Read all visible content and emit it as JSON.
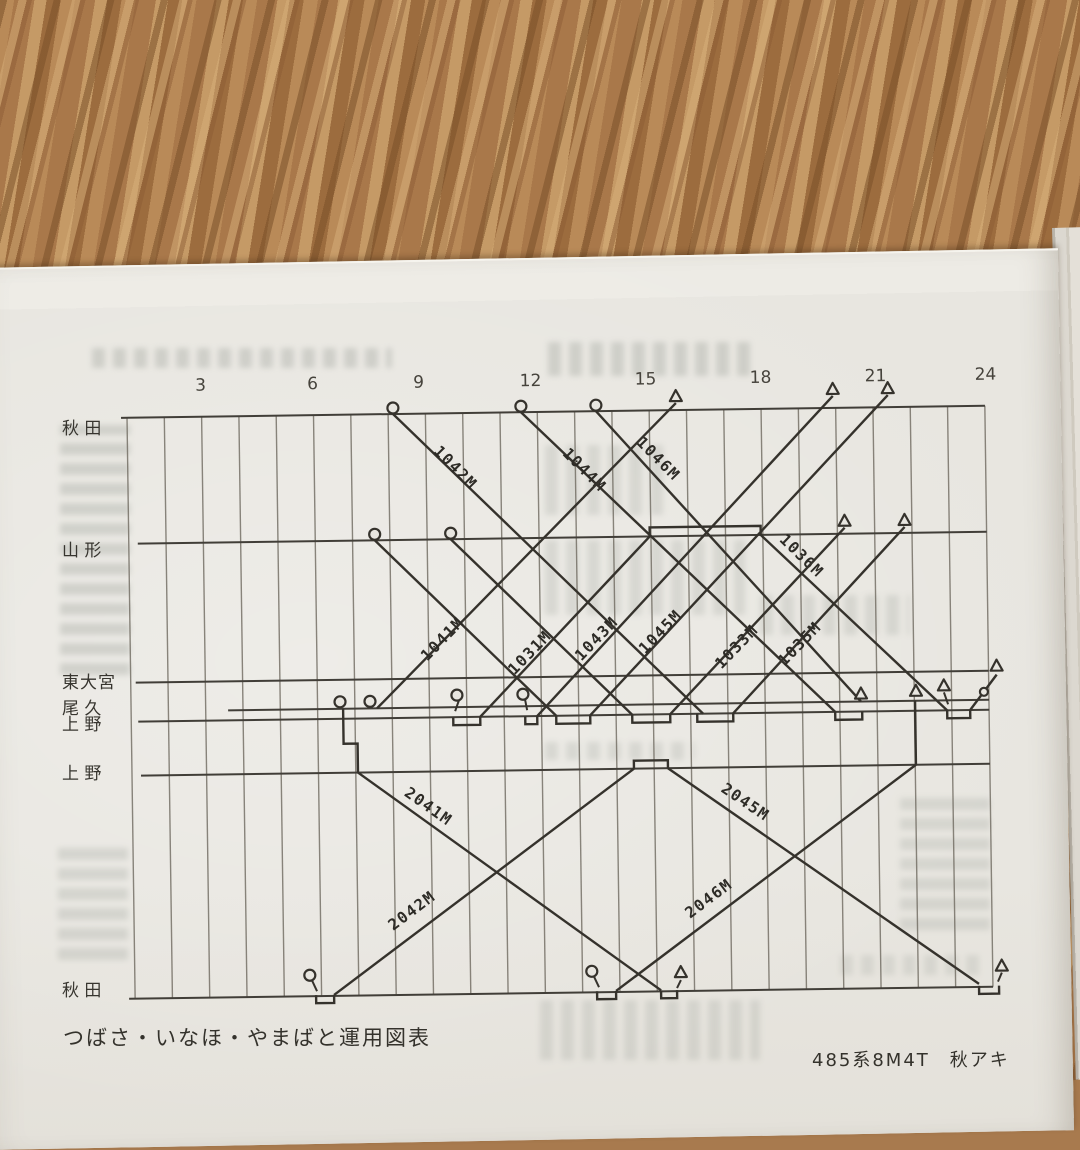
{
  "page": {
    "caption_left": "つばさ・いなほ・やまばと運用図表",
    "caption_right": "485系8M4T　秋アキ"
  },
  "diagram": {
    "title": "train operation diagram (運用図表)",
    "ink": "#35322c",
    "grid_ink": "#6f6a60",
    "paper": "#e8e6e0",
    "hours": {
      "labels": [
        "3",
        "6",
        "9",
        "12",
        "15",
        "18",
        "21",
        "24"
      ],
      "x": [
        205,
        317,
        423,
        535,
        650,
        765,
        880,
        990
      ],
      "y": 386
    },
    "grid": {
      "x0": 131,
      "dx": 37.3,
      "count": 24,
      "top": 412,
      "bottom": 993
    },
    "stations": [
      {
        "label": "秋 田",
        "y": 412,
        "x1": 125,
        "x2": 989,
        "label_top": 414
      },
      {
        "label": "山 形",
        "y": 538,
        "x1": 140,
        "x2": 989,
        "label_top": 536
      },
      {
        "label": "東大宮",
        "y": 677,
        "x1": 136,
        "x2": 989,
        "label_top": 668
      },
      {
        "label": "尾 久",
        "y": 706,
        "x1": 228,
        "x2": 989,
        "label_top": 694
      },
      {
        "label": "上 野",
        "y": 716,
        "x1": 138,
        "x2": 989,
        "label_top": 710
      },
      {
        "label": "上 野",
        "y": 770,
        "x1": 140,
        "x2": 989,
        "label_top": 759
      },
      {
        "label": "秋 田",
        "y": 993,
        "x1": 125,
        "x2": 989,
        "label_top": 976
      }
    ],
    "trains": [
      {
        "label": "1042M",
        "path": [
          [
            397,
            412
          ],
          [
            703,
            716
          ]
        ],
        "lx": 455,
        "ly": 470,
        "rot": 46
      },
      {
        "label": "1044M",
        "path": [
          [
            525,
            412
          ],
          [
            835,
            716
          ]
        ],
        "lx": 584,
        "ly": 474,
        "rot": 46
      },
      {
        "label": "1046M",
        "path": [
          [
            600,
            412
          ],
          [
            861,
            706
          ]
        ],
        "lx": 658,
        "ly": 464,
        "rot": 46
      },
      {
        "label": "",
        "path": [
          [
            377,
            538
          ],
          [
            556,
            716
          ]
        ]
      },
      {
        "label": "",
        "path": [
          [
            453,
            538
          ],
          [
            632,
            716
          ]
        ]
      },
      {
        "label": "1036M",
        "path": [
          [
            652,
            538
          ],
          [
            652,
            529
          ],
          [
            763,
            529
          ],
          [
            763,
            538
          ],
          [
            947,
            716
          ]
        ],
        "lx": 800,
        "ly": 563,
        "rot": 45
      },
      {
        "label": "1041M",
        "path": [
          [
            377,
            706
          ],
          [
            680,
            405
          ]
        ],
        "lx": 447,
        "ly": 641,
        "rot": -45
      },
      {
        "label": "1031M",
        "path": [
          [
            480,
            716
          ],
          [
            652,
            538
          ]
        ],
        "lx": 534,
        "ly": 656,
        "rot": -45
      },
      {
        "label": "1043M",
        "path": [
          [
            537,
            716
          ],
          [
            837,
            400
          ]
        ],
        "lx": 601,
        "ly": 643,
        "rot": -45
      },
      {
        "label": "1045M",
        "path": [
          [
            590,
            716
          ],
          [
            892,
            400
          ]
        ],
        "lx": 665,
        "ly": 637,
        "rot": -45
      },
      {
        "label": "1033M",
        "path": [
          [
            670,
            716
          ],
          [
            847,
            532
          ]
        ],
        "lx": 741,
        "ly": 653,
        "rot": -45
      },
      {
        "label": "1035M",
        "path": [
          [
            733,
            716
          ],
          [
            907,
            532
          ]
        ],
        "lx": 804,
        "ly": 651,
        "rot": -45
      },
      {
        "label": "2041M",
        "path": [
          [
            357,
            770
          ],
          [
            657,
            992
          ]
        ],
        "lx": 424,
        "ly": 809,
        "rot": 36
      },
      {
        "label": "2042M",
        "path": [
          [
            330,
            992
          ],
          [
            633,
            770
          ]
        ],
        "lx": 412,
        "ly": 913,
        "rot": -36
      },
      {
        "label": "2045M",
        "path": [
          [
            667,
            770
          ],
          [
            975,
            990
          ]
        ],
        "lx": 741,
        "ly": 809,
        "rot": 35
      },
      {
        "label": "2046M",
        "path": [
          [
            612,
            992
          ],
          [
            915,
            770
          ]
        ],
        "lx": 709,
        "ly": 905,
        "rot": -36
      },
      {
        "label": "",
        "path": [
          [
            343,
            706
          ],
          [
            343,
            741
          ],
          [
            357,
            741
          ],
          [
            357,
            770
          ]
        ]
      },
      {
        "label": "",
        "path": [
          [
            633,
            770
          ],
          [
            633,
            762
          ],
          [
            667,
            762
          ],
          [
            667,
            770
          ]
        ]
      },
      {
        "label": "",
        "path": [
          [
            915,
            770
          ],
          [
            915,
            706
          ]
        ]
      },
      {
        "label": "",
        "path": [
          [
            970,
            716
          ],
          [
            997,
            681
          ]
        ]
      }
    ],
    "notches": [
      {
        "x1": 453,
        "x2": 480,
        "y": 716,
        "d": 8
      },
      {
        "x1": 525,
        "x2": 537,
        "y": 716,
        "d": 8
      },
      {
        "x1": 556,
        "x2": 590,
        "y": 716,
        "d": 8
      },
      {
        "x1": 632,
        "x2": 670,
        "y": 716,
        "d": 8
      },
      {
        "x1": 697,
        "x2": 733,
        "y": 716,
        "d": 8
      },
      {
        "x1": 835,
        "x2": 862,
        "y": 716,
        "d": 8
      },
      {
        "x1": 947,
        "x2": 970,
        "y": 716,
        "d": 8
      },
      {
        "x1": 312,
        "x2": 330,
        "y": 992,
        "d": 8
      },
      {
        "x1": 593,
        "x2": 612,
        "y": 992,
        "d": 8
      },
      {
        "x1": 657,
        "x2": 673,
        "y": 992,
        "d": 8
      },
      {
        "x1": 975,
        "x2": 995,
        "y": 992,
        "d": 8
      }
    ],
    "circles": [
      {
        "x": 397,
        "y": 406
      },
      {
        "x": 525,
        "y": 406
      },
      {
        "x": 600,
        "y": 406
      },
      {
        "x": 377,
        "y": 532
      },
      {
        "x": 453,
        "y": 532
      },
      {
        "x": 340,
        "y": 699
      },
      {
        "x": 370,
        "y": 699
      },
      {
        "x": 457,
        "y": 694
      },
      {
        "x": 523,
        "y": 694
      },
      {
        "x": 306,
        "y": 972
      },
      {
        "x": 588,
        "y": 972
      },
      {
        "x": 984,
        "y": 698,
        "r": 4
      }
    ],
    "triangles": [
      {
        "x": 680,
        "y": 399
      },
      {
        "x": 837,
        "y": 394
      },
      {
        "x": 892,
        "y": 394
      },
      {
        "x": 847,
        "y": 526
      },
      {
        "x": 907,
        "y": 526
      },
      {
        "x": 861,
        "y": 699
      },
      {
        "x": 916,
        "y": 697
      },
      {
        "x": 944,
        "y": 692
      },
      {
        "x": 997,
        "y": 673
      },
      {
        "x": 677,
        "y": 975
      },
      {
        "x": 998,
        "y": 973
      }
    ],
    "stems": [
      [
        [
          459,
          699
        ],
        [
          455,
          710
        ]
      ],
      [
        [
          525,
          699
        ],
        [
          527,
          710
        ]
      ],
      [
        [
          308,
          977
        ],
        [
          313,
          988
        ]
      ],
      [
        [
          590,
          977
        ],
        [
          595,
          988
        ]
      ],
      [
        [
          677,
          982
        ],
        [
          673,
          990
        ]
      ],
      [
        [
          998,
          979
        ],
        [
          994,
          988
        ]
      ],
      [
        [
          944,
          698
        ],
        [
          948,
          710
        ]
      ]
    ]
  }
}
